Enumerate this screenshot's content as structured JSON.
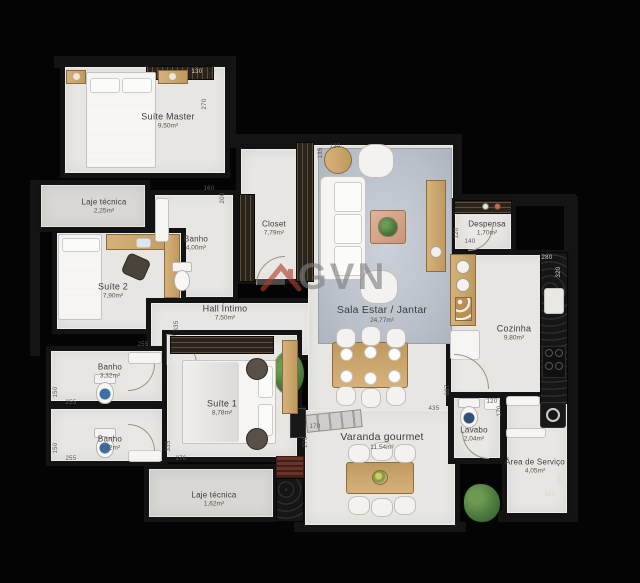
{
  "plan": {
    "watermark": {
      "text": "GVN",
      "icon": "roof-icon",
      "accent_color": "#b23b2e"
    },
    "palette": {
      "background": "#040404",
      "walls": "#141414",
      "floor": "#e8e6e2",
      "technical_floor": "#d9d7d3",
      "wood": "#c9a46a",
      "rug": "#b9bfc8"
    },
    "rooms": [
      {
        "id": "suite-master",
        "label": "Suíte Master",
        "area": "9,50m²"
      },
      {
        "id": "laje-tecnica-top",
        "label": "Laje técnica",
        "area": "2,25m²"
      },
      {
        "id": "banho-suite-master",
        "label": "Banho",
        "area": "4,00m²"
      },
      {
        "id": "closet",
        "label": "Closet",
        "area": "7,79m²"
      },
      {
        "id": "suite-2",
        "label": "Suíte 2",
        "area": "7,90m²"
      },
      {
        "id": "hall-intimo",
        "label": "Hall Íntimo",
        "area": "7,50m²"
      },
      {
        "id": "sala-estar-jantar",
        "label": "Sala Estar / Jantar",
        "area": "24,77m²"
      },
      {
        "id": "despensa",
        "label": "Despensa",
        "area": "1,70m²"
      },
      {
        "id": "cozinha",
        "label": "Cozinha",
        "area": "9,80m²"
      },
      {
        "id": "banho-2",
        "label": "Banho",
        "area": "3,32m²"
      },
      {
        "id": "banho-3",
        "label": "Banho",
        "area": "3,32m²"
      },
      {
        "id": "suite-1",
        "label": "Suíte 1",
        "area": "8,78m²"
      },
      {
        "id": "varanda-gourmet",
        "label": "Varanda gourmet",
        "area": "11,54m²"
      },
      {
        "id": "lavabo",
        "label": "Lavabo",
        "area": "2,04m²"
      },
      {
        "id": "area-servico",
        "label": "Área de Serviço",
        "area": "4,05m²"
      },
      {
        "id": "laje-tecnica-bottom",
        "label": "Laje técnica",
        "area": "1,62m²"
      }
    ],
    "dimensions": [
      {
        "t": "130"
      },
      {
        "t": "270"
      },
      {
        "t": "160"
      },
      {
        "t": "200"
      },
      {
        "t": "335"
      },
      {
        "t": "255"
      },
      {
        "t": "150"
      },
      {
        "t": "255"
      },
      {
        "t": "150"
      },
      {
        "t": "255"
      },
      {
        "t": "335"
      },
      {
        "t": "270"
      },
      {
        "t": "170"
      },
      {
        "t": "270"
      },
      {
        "t": "435"
      },
      {
        "t": "687"
      },
      {
        "t": "120"
      },
      {
        "t": "170"
      },
      {
        "t": "280"
      },
      {
        "t": "320"
      },
      {
        "t": "120"
      },
      {
        "t": "140"
      },
      {
        "t": "267"
      },
      {
        "t": "160"
      },
      {
        "t": "135"
      },
      {
        "t": "120"
      }
    ]
  }
}
